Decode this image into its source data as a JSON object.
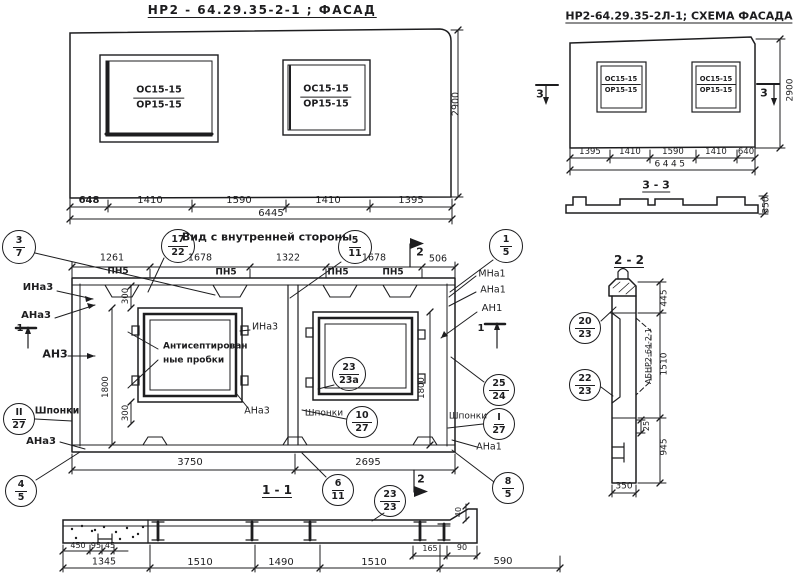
{
  "facade": {
    "title": "НР2 - 64.29.35-2-1 ;  ФАСАД",
    "dims": [
      "648",
      "1410",
      "1590",
      "1410",
      "1395"
    ],
    "total": "6445",
    "height": "2900"
  },
  "schema": {
    "title": "НР2-64.29.35-2Л-1; СХЕМА ФАСАДА",
    "dims": [
      "1395",
      "1410",
      "1590",
      "1410",
      "640"
    ],
    "total": "6445",
    "height": "2900",
    "cut_label": "3",
    "section_title": "3 - 3",
    "thickness": "350"
  },
  "window_mark": {
    "top": "ОС15-15",
    "bottom": "ОР15-15"
  },
  "inner": {
    "title": "Вид с внутренней стороны",
    "top_dims": [
      "1261",
      "1678",
      "1322",
      "1678",
      "506"
    ],
    "profile": "ПН5",
    "plugs": [
      "Антисептирован",
      "ные пробки"
    ],
    "keys_label": "Шпонки",
    "labels": {
      "ina3": "ИНа3",
      "ana3": "АНа3",
      "an3": "АН3",
      "mna1": "МНа1",
      "ana1": "АНа1",
      "an1": "АН1"
    },
    "v300": "300",
    "v1800": "1800",
    "bottom_dims": [
      "3750",
      "2695"
    ],
    "cut1": "1",
    "cut2": "2",
    "section_title": "1 - 1"
  },
  "section22": {
    "title": "2 - 2",
    "d445": "445",
    "d1510": "1510",
    "d945": "945",
    "d25": "25",
    "d350": "350",
    "stamp": "АБНР2-64-2-1"
  },
  "strip": {
    "small_dims": [
      "450",
      "95",
      "45"
    ],
    "dims": [
      "1345",
      "1510",
      "1490",
      "1510",
      "590"
    ],
    "d165": "165",
    "d90": "90",
    "d40": "40"
  },
  "callouts": {
    "c3_7": {
      "top": "3",
      "bot": "7"
    },
    "c17_22": {
      "top": "17",
      "bot": "22"
    },
    "c5_11": {
      "top": "5",
      "bot": "11"
    },
    "c1_5": {
      "top": "1",
      "bot": "5"
    },
    "c25_24": {
      "top": "25",
      "bot": "24"
    },
    "cI_27": {
      "top": "I",
      "bot": "27"
    },
    "cII_27": {
      "top": "II",
      "bot": "27"
    },
    "c10_27": {
      "top": "10",
      "bot": "27"
    },
    "c23_23a": {
      "top": "23",
      "bot": "23а"
    },
    "c6_11": {
      "top": "6",
      "bot": "11"
    },
    "c23_23": {
      "top": "23",
      "bot": "23"
    },
    "c8_5": {
      "top": "8",
      "bot": "5"
    },
    "c4_5": {
      "top": "4",
      "bot": "5"
    },
    "c20_23": {
      "top": "20",
      "bot": "23"
    },
    "c22_23": {
      "top": "22",
      "bot": "23"
    }
  }
}
